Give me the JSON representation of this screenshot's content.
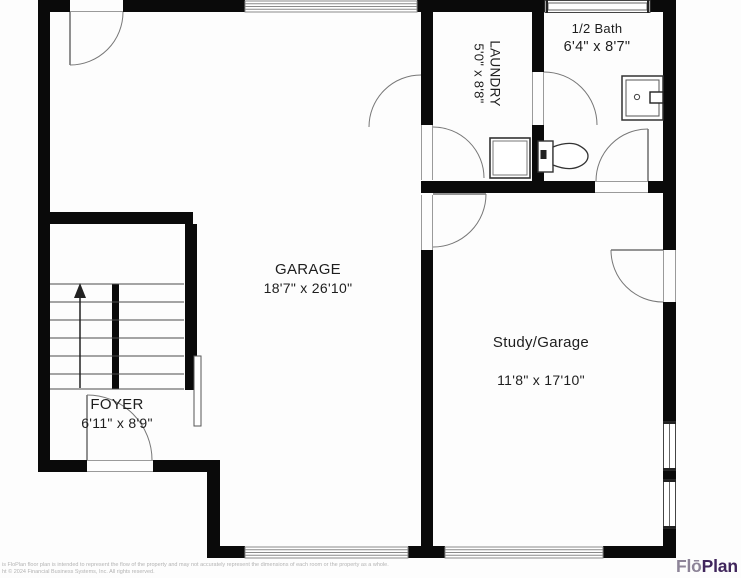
{
  "rooms": {
    "garage": {
      "name": "GARAGE",
      "dims": "18'7\" x 26'10\""
    },
    "study_garage": {
      "name": "Study/Garage",
      "dims": "11'8\" x 17'10\""
    },
    "half_bath": {
      "name": "1/2 Bath",
      "dims": "6'4\" x 8'7\""
    },
    "laundry": {
      "name": "LAUNDRY",
      "dims": "5'0\" x 8'8\""
    },
    "foyer": {
      "name": "FOYER",
      "dims": "6'11\" x 8'9\""
    }
  },
  "footer": {
    "disclaimer_line1": "is FloPlan floor plan is intended to represent the flow of the property and may not accurately represent the dimensions of each room or the property as a whole.",
    "disclaimer_line2": "ht © 2024 Financial Business Systems, Inc. All rights reserved."
  },
  "logo": {
    "prefix": "Flō",
    "suffix": "Plan",
    "prefix_color": "#8d8498",
    "suffix_color": "#40265c"
  },
  "colors": {
    "wall": "#0a0a0a",
    "thin_line": "#555555",
    "arc_line": "#777777",
    "hatch_line": "#8a8a8a"
  }
}
